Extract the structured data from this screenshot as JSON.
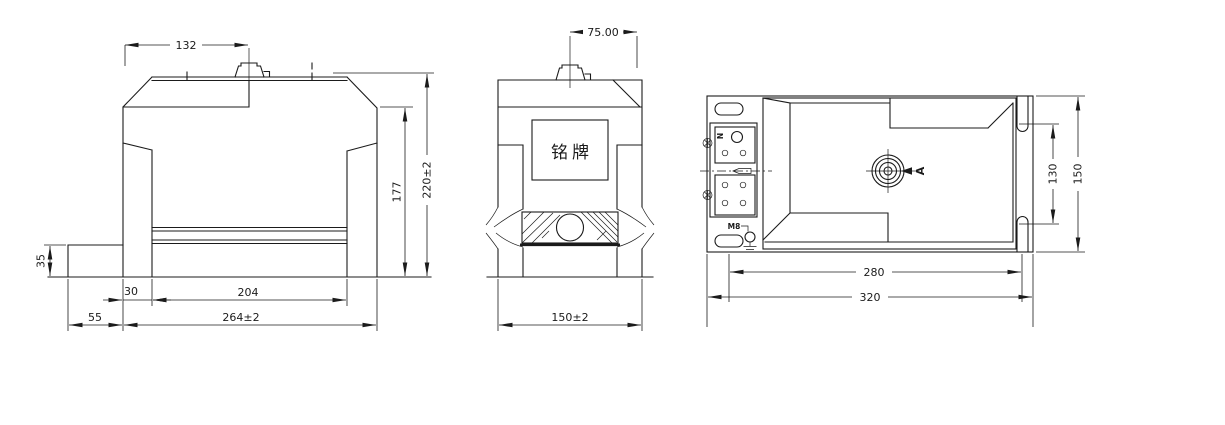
{
  "drawing": {
    "background": "#ffffff",
    "line_color": "#1b1b1b",
    "front_view": {
      "dim_terminal_offset": "132",
      "dim_inner_height": "177",
      "dim_overall_height": "220±2",
      "dim_step_height": "35",
      "dim_leg_width": "30",
      "dim_inner_width": "204",
      "dim_step_width": "55",
      "dim_overall_width": "264±2"
    },
    "side_view": {
      "dim_terminal_offset": "75.00",
      "dim_overall_width": "150±2",
      "nameplate_text": "铭牌"
    },
    "top_view": {
      "dim_slot_span": "130",
      "dim_overall_depth": "150",
      "dim_mount_span": "280",
      "dim_overall_width": "320",
      "label_neutral": "N",
      "label_ground_thread": "M8",
      "label_view_arrow": "A"
    }
  }
}
